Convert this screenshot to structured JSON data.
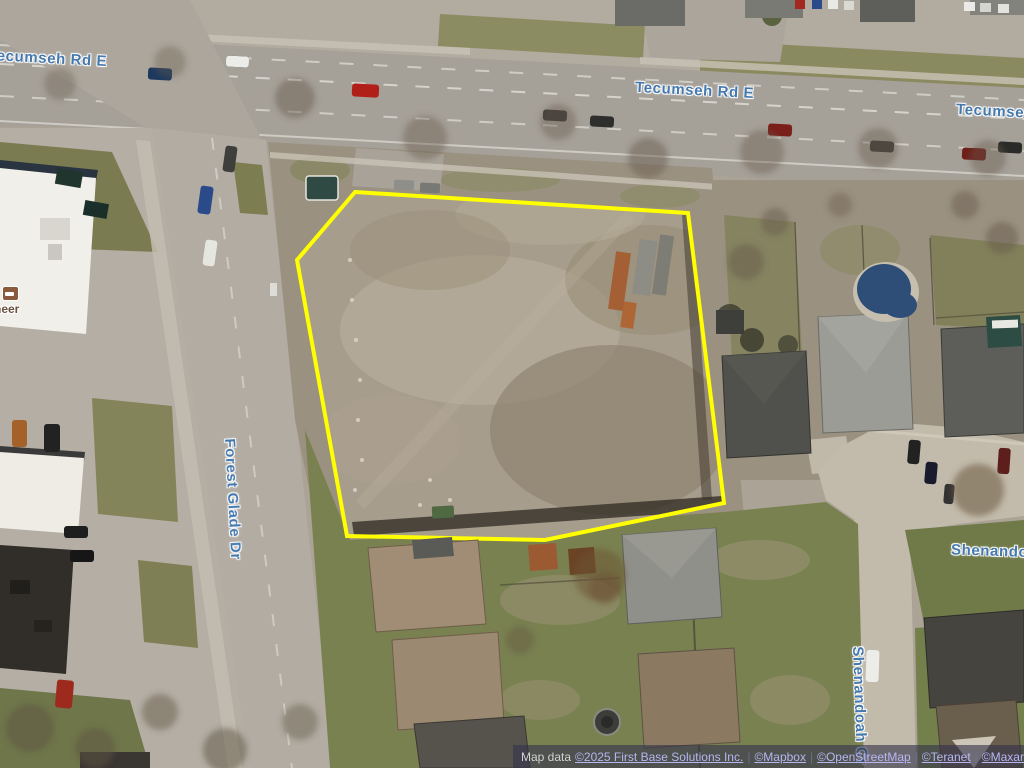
{
  "map": {
    "view": "satellite-aerial",
    "road_labels": [
      {
        "id": "tecumseh-rd-e-west",
        "text": "Tecumseh Rd E"
      },
      {
        "id": "tecumseh-rd-e-center",
        "text": "Tecumseh Rd E"
      },
      {
        "id": "tecumseh-rd-e-east",
        "text": "Tecumseh Rd E"
      },
      {
        "id": "forest-glade-dr",
        "text": "Forest Glade Dr"
      },
      {
        "id": "shenandoah-east",
        "text": "Shenandoah"
      },
      {
        "id": "shenandoah-cr",
        "text": "Shenandoah Cr"
      }
    ],
    "poi": {
      "label_fragment": "neer",
      "icon": "lodging-icon"
    },
    "parcel_outline_color": "#ffff00",
    "road_label_color": "#4579ae"
  },
  "attribution": {
    "prefix": "Map data",
    "separator": "|",
    "links": [
      {
        "label": "©2025 First Base Solutions Inc."
      },
      {
        "label": "©Mapbox"
      },
      {
        "label": "©OpenStreetMap"
      },
      {
        "label": "©Teranet"
      },
      {
        "label": "©Maxar"
      }
    ]
  }
}
